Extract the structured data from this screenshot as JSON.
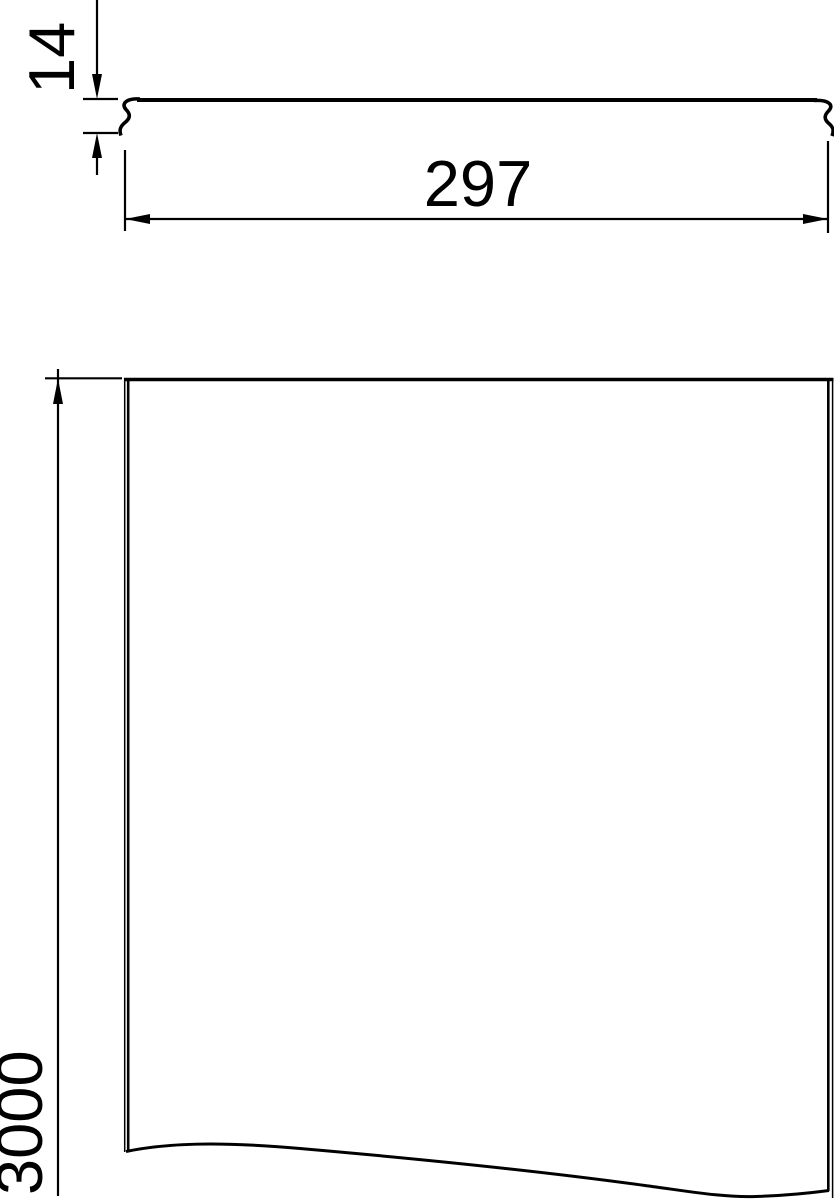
{
  "drawing": {
    "background_color": "#ffffff",
    "line_color": "#000000",
    "dimensions": {
      "thickness": {
        "value": "14"
      },
      "width": {
        "value": "297"
      },
      "length": {
        "value": "3000"
      }
    }
  }
}
